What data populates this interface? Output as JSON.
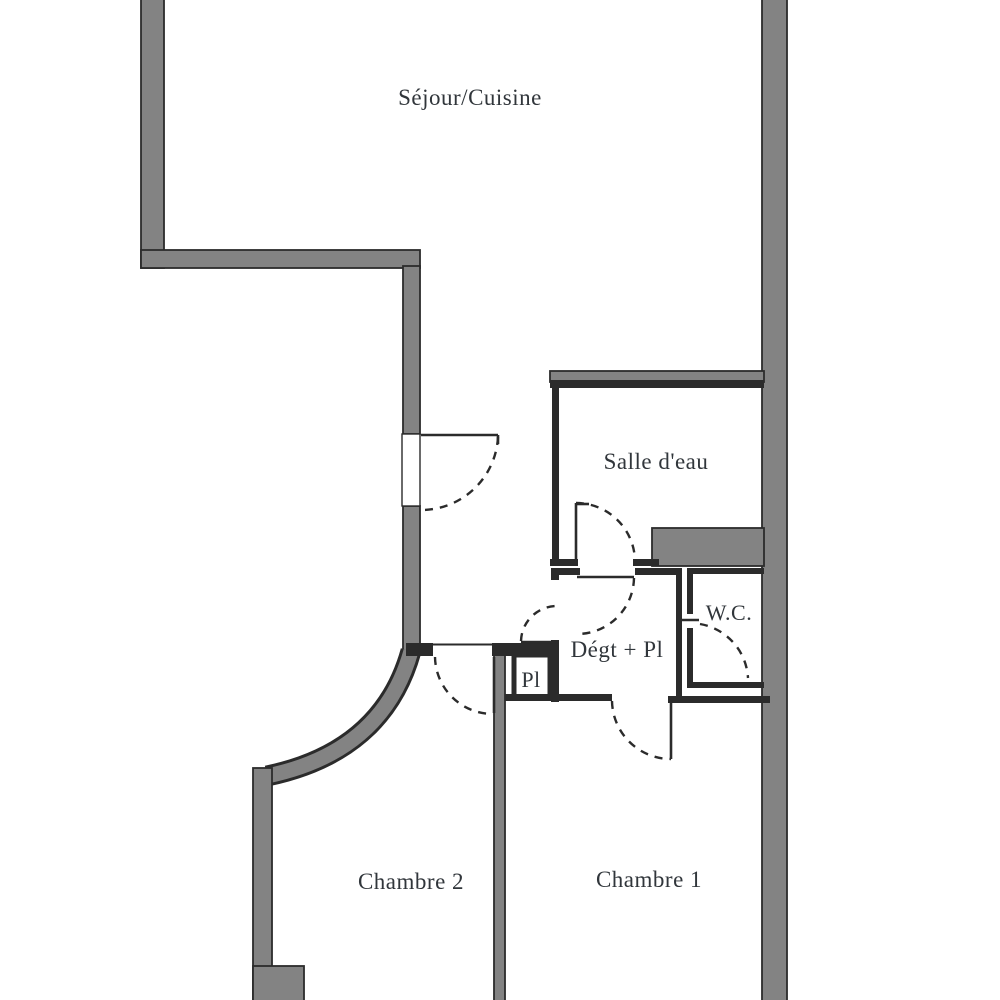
{
  "page": {
    "type": "apartment-floor-plan"
  },
  "colors": {
    "wall_fill": "#838383",
    "line": "#2b2b2b",
    "text": "#31363b",
    "background": "#ffffff"
  },
  "rooms": [
    {
      "id": "sejour-cuisine",
      "label": "Séjour/Cuisine"
    },
    {
      "id": "salle-d-eau",
      "label": "Salle d'eau"
    },
    {
      "id": "degagement-placard",
      "label": "Dégt + Pl"
    },
    {
      "id": "wc",
      "label": "W.C."
    },
    {
      "id": "placard",
      "label": "Pl"
    },
    {
      "id": "chambre-2",
      "label": "Chambre 2"
    },
    {
      "id": "chambre-1",
      "label": "Chambre 1"
    }
  ]
}
